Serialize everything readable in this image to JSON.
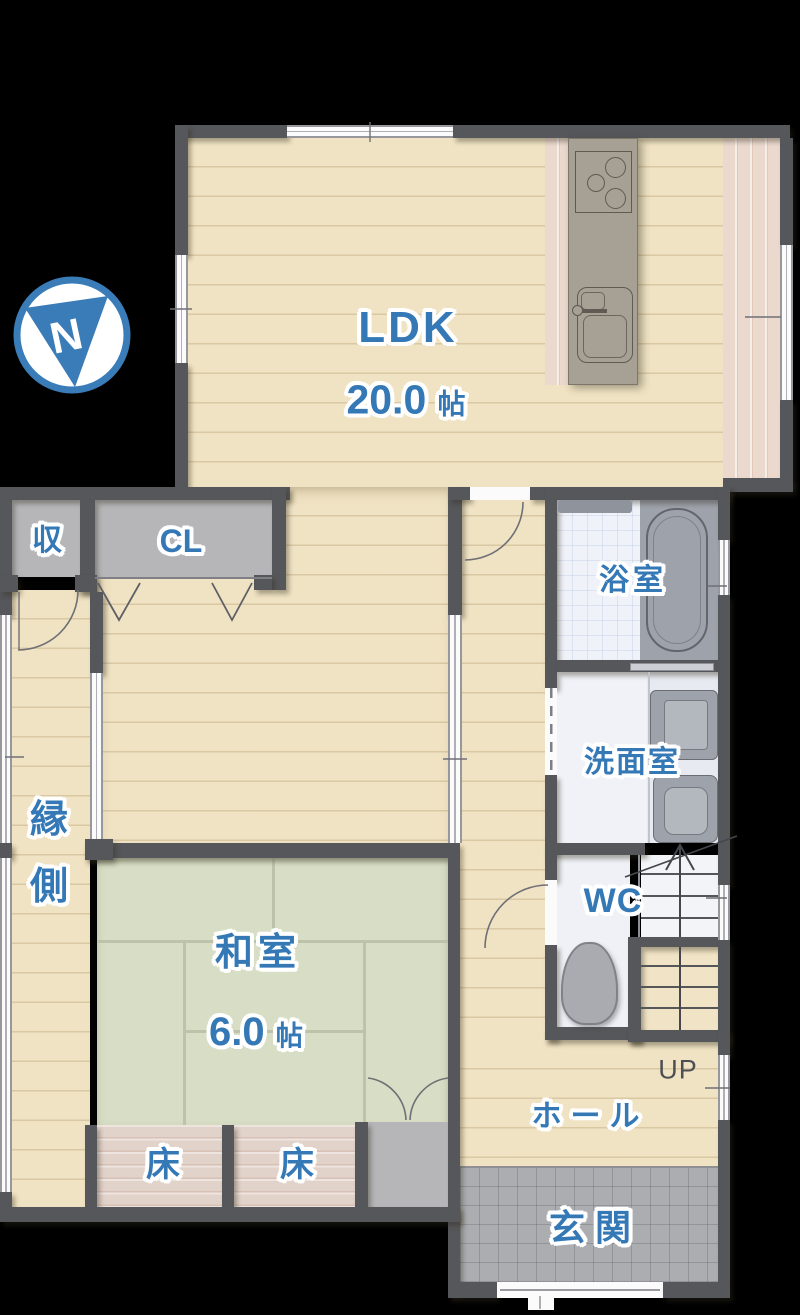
{
  "compass": {
    "letter": "N"
  },
  "rooms": {
    "ldk": {
      "label": "LDK",
      "area": "20.0",
      "unit": "帖"
    },
    "washitsu": {
      "label": "和室",
      "area": "6.0",
      "unit": "帖"
    },
    "bath": {
      "label": "浴室"
    },
    "washroom": {
      "label": "洗面室"
    },
    "wc": {
      "label": "WC"
    },
    "hall": {
      "label": "ホール"
    },
    "genkan": {
      "label": "玄関"
    },
    "engawa": {
      "char1": "縁",
      "char2": "側"
    },
    "storage": {
      "label": "収"
    },
    "closet": {
      "label": "CL"
    },
    "toko1": {
      "label": "床"
    },
    "toko2": {
      "label": "床"
    },
    "stairs": {
      "label": "UP"
    }
  },
  "colors": {
    "background": "#000000",
    "wall": "#56575B",
    "accent_blue": "#3578B6",
    "wood_floor": "#F0E3C3",
    "tatami_green": "#D8DEC5",
    "deck_wood": "#EBD9CE",
    "toko_wood": "#E2D3CA",
    "closet_grey": "#B6B6B9",
    "bath_tile": "#EFF2F8",
    "fixture_grey": "#9EA2AA",
    "genkan_tile": "#ACADB1",
    "stair_tread": "#F1E4C6",
    "label_outline": "#FFFFFF",
    "up_text": "#4E4F54"
  }
}
